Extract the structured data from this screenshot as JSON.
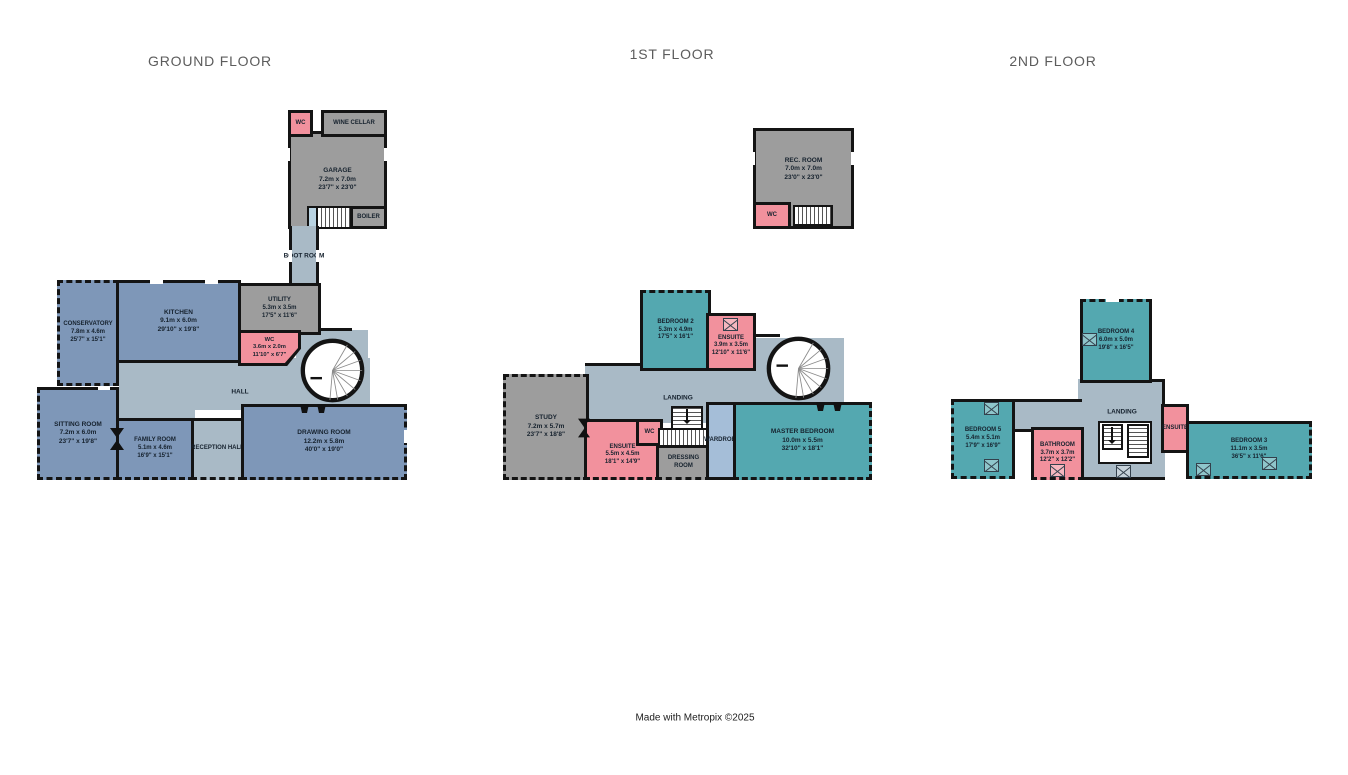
{
  "colors": {
    "wall": "#141414",
    "room_blue": "#7e97b8",
    "room_teal": "#54a8b0",
    "room_gray": "#9d9d9d",
    "room_pink": "#f2919d",
    "circulation": "#a9bac6",
    "wardrobe": "#a5bed8",
    "stair_cell": "#b9d3e2"
  },
  "footer": "Made with Metropix ©2025",
  "floors": [
    {
      "title": "GROUND FLOOR",
      "rooms": {
        "wc_garage": {
          "name": "WC"
        },
        "wine_cellar": {
          "name": "WINE CELLAR"
        },
        "garage": {
          "name": "GARAGE",
          "metric": "7.2m x 7.0m",
          "imperial": "23'7\" x 23'0\""
        },
        "boiler": {
          "name": "BOILER"
        },
        "boot_room": {
          "name": "BOOT ROOM"
        },
        "utility": {
          "name": "UTILITY",
          "metric": "5.3m x 3.5m",
          "imperial": "17'5\" x 11'6\""
        },
        "kitchen": {
          "name": "KITCHEN",
          "metric": "9.1m x 6.0m",
          "imperial": "29'10\" x 19'8\""
        },
        "conservatory": {
          "name": "CONSERVATORY",
          "metric": "7.8m x 4.6m",
          "imperial": "25'7\" x 15'1\""
        },
        "wc_hall": {
          "name": "WC",
          "metric": "3.6m x 2.0m",
          "imperial": "11'10\" x 6'7\""
        },
        "hall": {
          "name": "HALL"
        },
        "sitting_room": {
          "name": "SITTING ROOM",
          "metric": "7.2m x 6.0m",
          "imperial": "23'7\" x 19'8\""
        },
        "family_room": {
          "name": "FAMILY ROOM",
          "metric": "5.1m x 4.6m",
          "imperial": "16'9\" x 15'1\""
        },
        "reception_hall": {
          "name": "RECEPTION HALL"
        },
        "drawing_room": {
          "name": "DRAWING ROOM",
          "metric": "12.2m x 5.8m",
          "imperial": "40'0\" x 19'0\""
        }
      }
    },
    {
      "title": "1ST FLOOR",
      "rooms": {
        "rec_room": {
          "name": "REC. ROOM",
          "metric": "7.0m x 7.0m",
          "imperial": "23'0\" x 23'0\""
        },
        "wc": {
          "name": "WC"
        },
        "bedroom_2": {
          "name": "BEDROOM 2",
          "metric": "5.3m x 4.9m",
          "imperial": "17'5\" x 16'1\""
        },
        "ensuite_2": {
          "name": "ENSUITE",
          "metric": "3.9m x 3.5m",
          "imperial": "12'10\" x 11'6\""
        },
        "landing": {
          "name": "LANDING"
        },
        "study": {
          "name": "STUDY",
          "metric": "7.2m x 5.7m",
          "imperial": "23'7\" x 18'8\""
        },
        "ensuite_master": {
          "name": "ENSUITE",
          "metric": "5.5m x 4.5m",
          "imperial": "18'1\" x 14'9\""
        },
        "wc_small": {
          "name": "WC"
        },
        "dressing_room": {
          "name": "DRESSING ROOM"
        },
        "wardrobe": {
          "name": "WARDROBE"
        },
        "master_bedroom": {
          "name": "MASTER BEDROOM",
          "metric": "10.0m x 5.5m",
          "imperial": "32'10\" x 18'1\""
        }
      }
    },
    {
      "title": "2ND FLOOR",
      "rooms": {
        "bedroom_4": {
          "name": "BEDROOM 4",
          "metric": "6.0m x 5.0m",
          "imperial": "19'8\" x 16'5\""
        },
        "bedroom_5": {
          "name": "BEDROOM 5",
          "metric": "5.4m x 5.1m",
          "imperial": "17'9\" x 16'9\""
        },
        "bathroom": {
          "name": "BATHROOM",
          "metric": "3.7m x 3.7m",
          "imperial": "12'2\" x 12'2\""
        },
        "landing": {
          "name": "LANDING"
        },
        "ensuite": {
          "name": "ENSUITE"
        },
        "bedroom_3": {
          "name": "BEDROOM 3",
          "metric": "11.1m x 3.5m",
          "imperial": "36'5\" x 11'6\""
        }
      }
    }
  ]
}
